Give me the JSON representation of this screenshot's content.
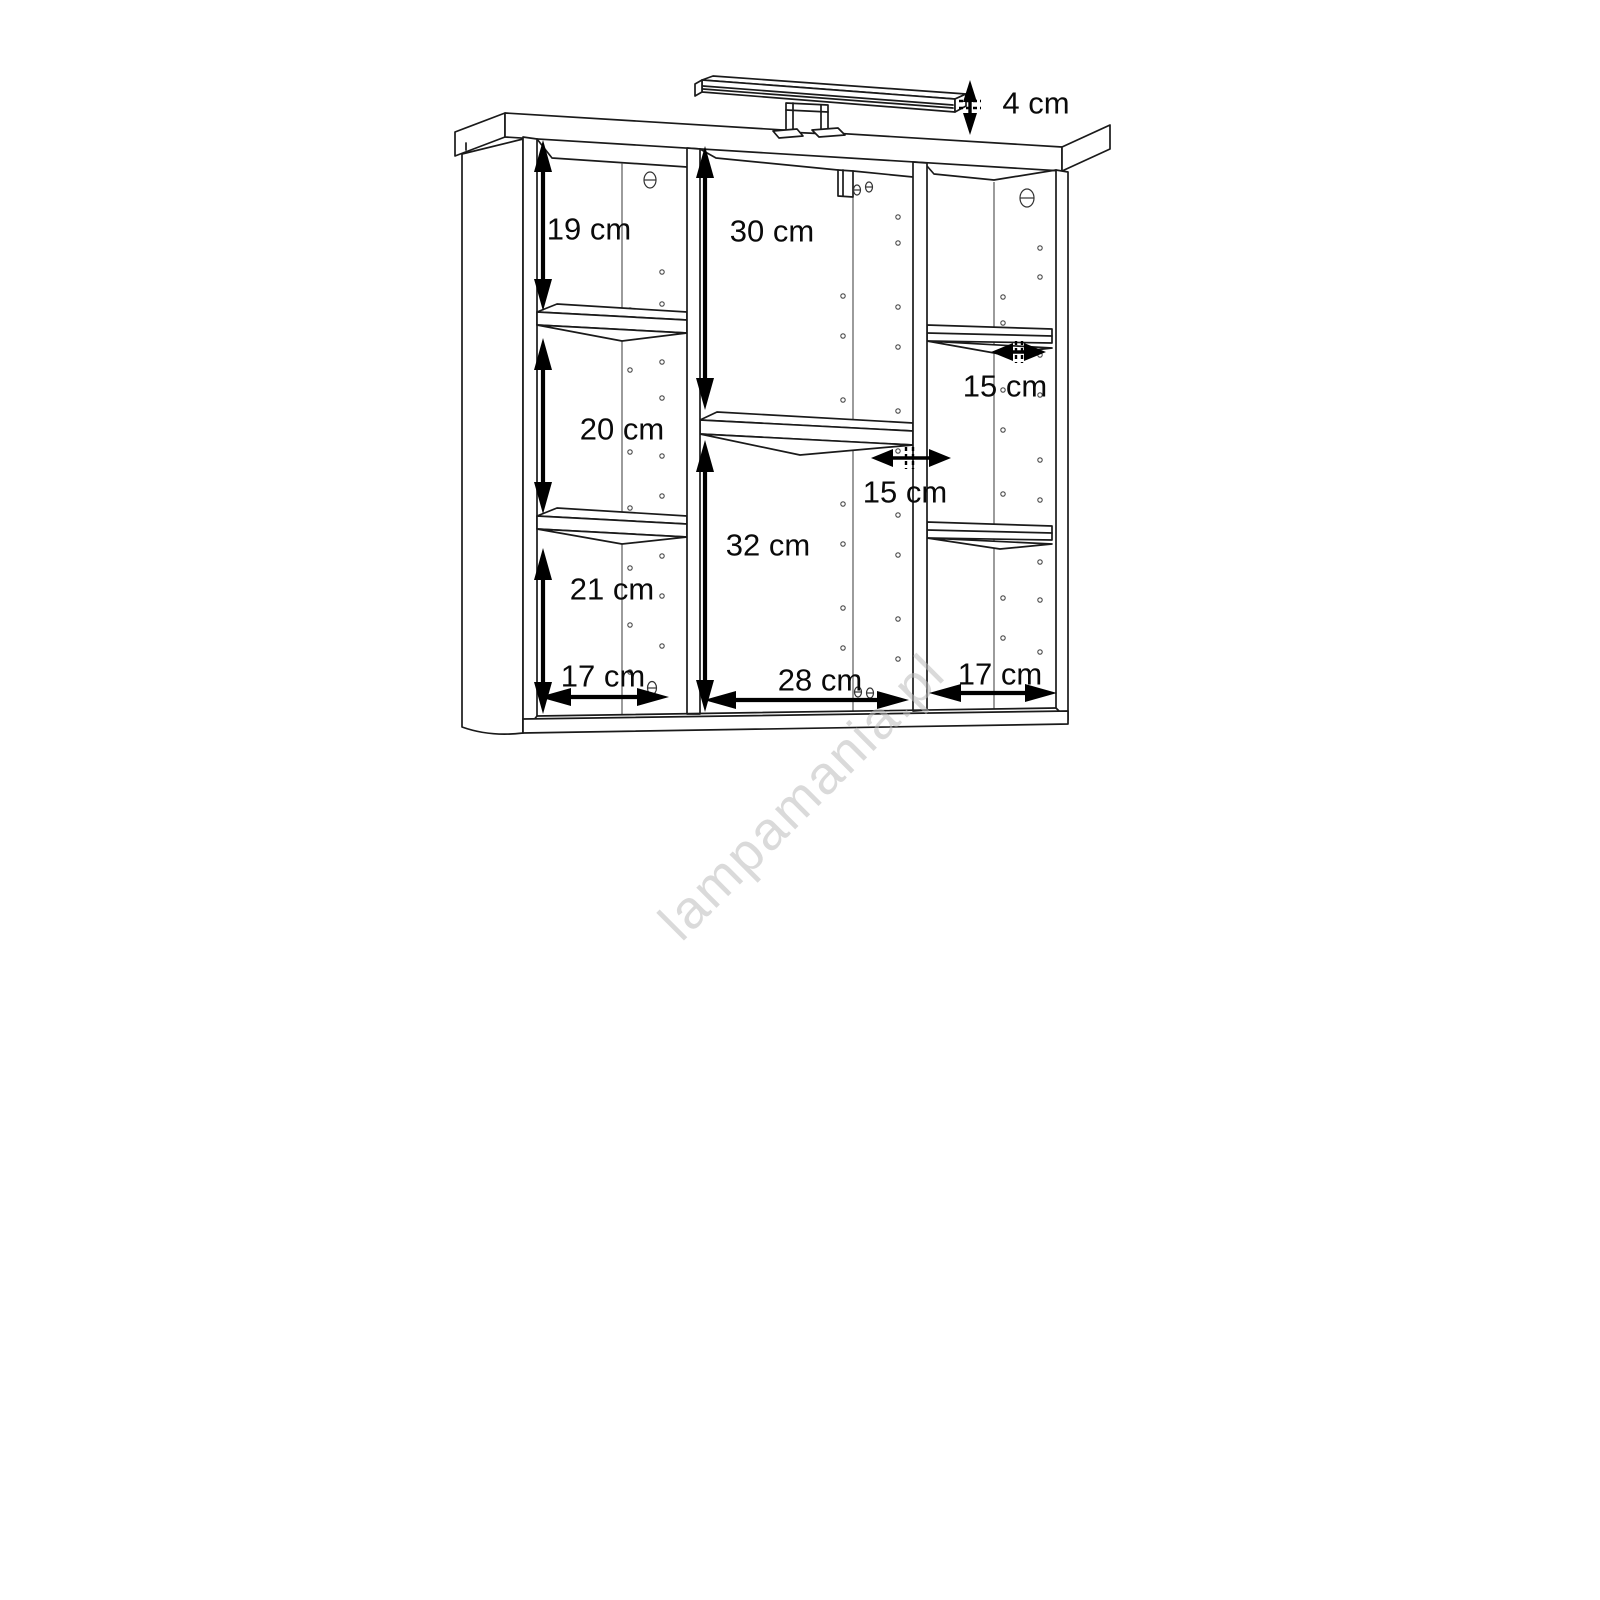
{
  "diagram": {
    "subject": "Bathroom mirror wall cabinet with overhead LED lamp - dimensioned technical line drawing",
    "watermark": "lampamania.pl",
    "colors": {
      "line": "#1a1a1a",
      "dimension": "#000000",
      "watermark": "#bdbdbd",
      "background": "#ffffff"
    }
  },
  "dims": {
    "lamp_height": "4 cm",
    "left_top": "19 cm",
    "left_middle": "20 cm",
    "left_bottom": "21 cm",
    "left_width": "17 cm",
    "center_top": "30 cm",
    "center_bottom": "32 cm",
    "center_width": "28 cm",
    "center_shelf_depth": "15 cm",
    "right_shelf_depth": "15 cm",
    "right_width": "17 cm"
  }
}
